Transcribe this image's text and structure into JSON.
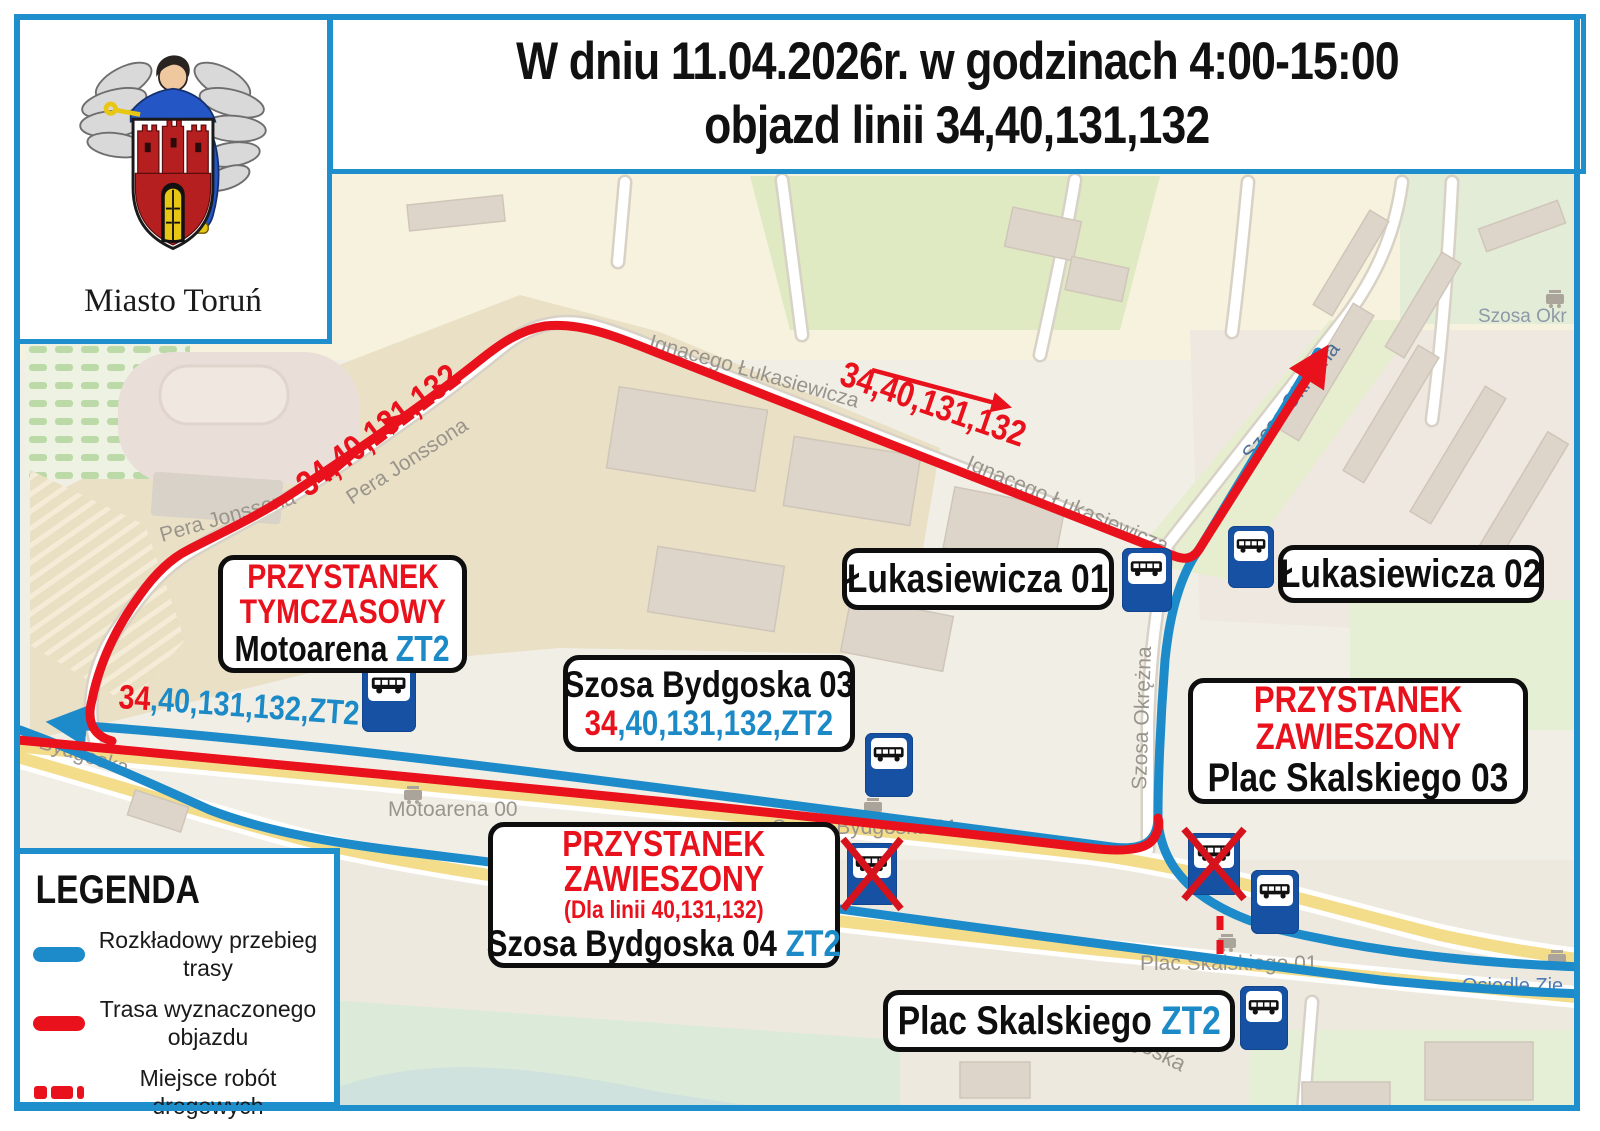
{
  "colors": {
    "frame_blue": "#1f8ecd",
    "route_blue": "#1d8bca",
    "detour_red": "#e8111c",
    "zt2_blue": "#1b8ac6",
    "stop_icon_blue": "#1751a4"
  },
  "header": {
    "line1": "W dniu 11.04.2026r. w godzinach 4:00-15:00",
    "line2": "objazd linii 34,40,131,132"
  },
  "logo": {
    "caption": "Miasto Toruń"
  },
  "legend": {
    "title": "LEGENDA",
    "items": [
      {
        "line1": "Rozkładowy przebieg",
        "line2": "trasy"
      },
      {
        "line1": "Trasa wyznaczonego",
        "line2": "objazdu"
      },
      {
        "line1": "Miejsce robót",
        "line2": "drogowych"
      }
    ]
  },
  "labels": {
    "temp_stop": {
      "title1": "PRZYSTANEK",
      "title2": "TYMCZASOWY",
      "name": "Motoarena",
      "suffix": "ZT2"
    },
    "luk01": {
      "text": "Łukasiewicza 01"
    },
    "luk02": {
      "text": "Łukasiewicza 02"
    },
    "bydgoska03": {
      "name": "Szosa Bydgoska 03",
      "lines_red": "34",
      "lines_rest": ",40,131,132,ZT2"
    },
    "plac03": {
      "title1": "PRZYSTANEK",
      "title2": "ZAWIESZONY",
      "name": "Plac Skalskiego 03"
    },
    "bydgoska04": {
      "title1": "PRZYSTANEK",
      "title2": "ZAWIESZONY",
      "subtitle": "(Dla linii 40,131,132)",
      "name": "Szosa Bydgoska 04",
      "suffix": "ZT2"
    },
    "plac_zt2": {
      "name": "Plac Skalskiego",
      "suffix": "ZT2"
    }
  },
  "annotations": {
    "pera_lines": "34,40,131,132",
    "luk_lines": "34,40,131,132",
    "bydgoska_lines_red": "34",
    "bydgoska_lines_rest": ",40,131,132,ZT2"
  },
  "streets": {
    "pera1": "Pera Jonssona",
    "pera2": "Pera Jonssona",
    "ignacego1": "Ignacego Łukasiewicza",
    "ignacego2": "Ignacego Łukasiewicza",
    "okrezna1": "Szosa Okrężna",
    "okrezna2": "Szosa Okrężna",
    "okrezna_corner": "Szosa Okr",
    "bydgoska": "Bydgoska",
    "bydgoska2": "Bydgoska",
    "motoarena00": "Motoarena 00",
    "szosa_bydgoska01": "Szosa Bydgoska 01",
    "plac_skalskiego01": "Plac Skalskiego 01",
    "osiedle": "Osiedle Zie"
  }
}
